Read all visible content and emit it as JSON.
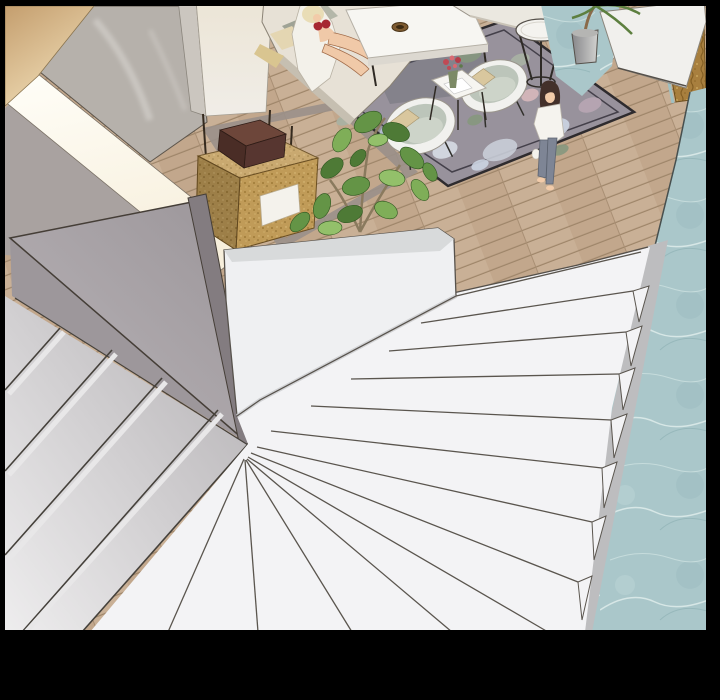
{
  "panel": {
    "type": "webtoon-comic-panel",
    "scene": "overhead view from top of a staircase descending into a modern living room",
    "frame": {
      "color": "#000000",
      "top_px": 6,
      "left_px": 5,
      "right_px": 14,
      "bottom_px": 70
    },
    "palette": {
      "wood_floor": "#c9b096",
      "wood_line": "#9e8569",
      "teal_marble": "#aac7ca",
      "tan_wall": "#c49e6e",
      "marble_wall": "#b6b1ab",
      "handrail_glow": "#fffef8",
      "balustrade_gray": "#9b9599",
      "stair_white": "#f3f3f5",
      "stair_gray": "#d8d6d8",
      "parapet_white": "#eff0f2",
      "cork_box": "#c09b58",
      "wood_box_brown": "#5f3c30",
      "sofa_cream": "#e7e1d6",
      "cushion_sage": "#9fa396",
      "cushion_yellow": "#d9c590",
      "rug_base": "#98929c",
      "rug_flower_blue": "#cdd5e3",
      "rug_leaf_green": "#87987f",
      "armchair_sage": "#bcc5ba",
      "table_white": "#f7f6f2",
      "flower_red": "#c04a55",
      "plant_green": "#649446",
      "skin": "#f0c9a8",
      "bikini_red": "#a62832",
      "hair_blonde": "#e9ddb6",
      "hair_brown": "#43302a",
      "jeans_gray": "#7e8595",
      "gold_door": "#a87f3e",
      "planter_gray": "#b5b5b3"
    },
    "objects": [
      "black-frame",
      "wood-floor",
      "teal-marble-floor",
      "tan-wall",
      "marble-wall",
      "handrail-light-band",
      "white-column",
      "cork-pendant-box",
      "brown-box",
      "floral-rug",
      "sofa-with-lounging-woman",
      "coffee-table",
      "ashtray",
      "armchair-left",
      "armchair-right",
      "flower-side-table",
      "round-side-table",
      "second-sofa",
      "potted-palm",
      "gold-door",
      "white-wall-panel",
      "standing-woman",
      "large-plant",
      "gray-balustrade",
      "left-gray-stairs",
      "white-winder-staircase",
      "white-parapet-wall",
      "stair-stringer"
    ]
  }
}
